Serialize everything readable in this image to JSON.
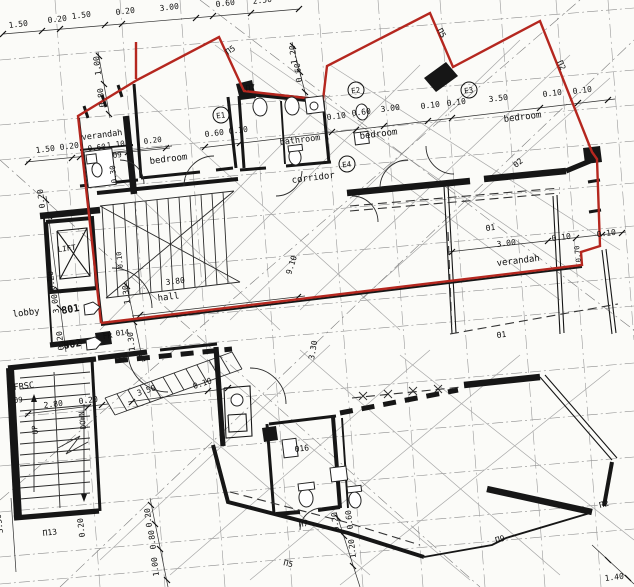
{
  "colors": {
    "paper": "#fbfbf8",
    "ink": "#161616",
    "red_outline": "#b5271f"
  },
  "plan": {
    "rooms": [
      "verandah",
      "bedroom",
      "bathroom",
      "bedroom",
      "bedroom",
      "corridor",
      "hall",
      "lobby",
      "LIFT",
      "verandah",
      "FRSC"
    ],
    "unit_markers": [
      "801",
      "802"
    ],
    "circled_refs": [
      "E1",
      "E2",
      "E3",
      "E4"
    ]
  },
  "labels": [
    {
      "t": "1.50",
      "x": 9,
      "y": 28,
      "n": "dim"
    },
    {
      "t": "0.20",
      "x": 48,
      "y": 23,
      "n": "dim"
    },
    {
      "t": "1.50",
      "x": 72,
      "y": 19,
      "n": "dim"
    },
    {
      "t": "0.20",
      "x": 116,
      "y": 15,
      "n": "dim"
    },
    {
      "t": "3.00",
      "x": 160,
      "y": 11,
      "n": "dim"
    },
    {
      "t": "0.60",
      "x": 216,
      "y": 7,
      "n": "dim"
    },
    {
      "t": "2.50",
      "x": 253,
      "y": 4,
      "n": "dim"
    },
    {
      "t": "1.00",
      "x": 101,
      "y": 75,
      "r": -97,
      "n": "dim"
    },
    {
      "t": "0.80",
      "x": 105,
      "y": 107,
      "r": -97,
      "n": "dim"
    },
    {
      "t": "1.20",
      "x": 297,
      "y": 64,
      "r": -97,
      "n": "dim"
    },
    {
      "t": "0.60",
      "x": 302,
      "y": 82,
      "r": -97,
      "n": "dim"
    },
    {
      "t": "1.50",
      "x": 36,
      "y": 153,
      "n": "dim"
    },
    {
      "t": "0.20",
      "x": 60,
      "y": 150,
      "n": "dim"
    },
    {
      "t": "verandah",
      "x": 82,
      "y": 140,
      "s": 8.5,
      "n": "room-verandah-nw"
    },
    {
      "t": "0.60",
      "x": 88,
      "y": 151,
      "s": 7.5,
      "n": "dim"
    },
    {
      "t": "1.10",
      "x": 107,
      "y": 148,
      "s": 7.5,
      "n": "dim"
    },
    {
      "t": "0.20",
      "x": 144,
      "y": 144,
      "s": 7.5,
      "n": "dim"
    },
    {
      "t": "Θ9",
      "x": 113,
      "y": 158,
      "s": 7.5,
      "n": "door-code"
    },
    {
      "t": "0.30",
      "x": 117,
      "y": 183,
      "r": -97,
      "s": 7.5,
      "n": "dim"
    },
    {
      "t": "bedroom",
      "x": 150,
      "y": 164,
      "s": 9,
      "n": "room-bedroom-1"
    },
    {
      "t": "bathroom",
      "x": 280,
      "y": 145,
      "s": 8.5,
      "n": "room-bathroom"
    },
    {
      "t": "bedroom",
      "x": 360,
      "y": 139,
      "s": 9,
      "n": "room-bedroom-2"
    },
    {
      "t": "bedroom",
      "x": 504,
      "y": 122,
      "s": 9,
      "n": "room-bedroom-3"
    },
    {
      "t": "corridor",
      "x": 292,
      "y": 183,
      "s": 9,
      "n": "room-corridor"
    },
    {
      "t": "E1",
      "x": 221,
      "y": 118,
      "c": true,
      "n": "ref-e1"
    },
    {
      "t": "E2",
      "x": 356,
      "y": 93,
      "c": true,
      "n": "ref-e2"
    },
    {
      "t": "E3",
      "x": 469,
      "y": 93,
      "c": true,
      "n": "ref-e3"
    },
    {
      "t": "E4",
      "x": 347,
      "y": 167,
      "c": true,
      "n": "ref-e4"
    },
    {
      "t": "Π5",
      "x": 228,
      "y": 55,
      "r": -35,
      "n": "window-code"
    },
    {
      "t": "Π7",
      "x": 246,
      "y": 91,
      "n": "window-code"
    },
    {
      "t": "Π5",
      "x": 437,
      "y": 30,
      "r": 62,
      "n": "window-code"
    },
    {
      "t": "Π2",
      "x": 557,
      "y": 62,
      "r": 65,
      "n": "window-code"
    },
    {
      "t": "Θ2",
      "x": 516,
      "y": 168,
      "r": -40,
      "n": "door-code"
    },
    {
      "t": "0.60",
      "x": 205,
      "y": 137,
      "n": "dim"
    },
    {
      "t": "0.10",
      "x": 229,
      "y": 134,
      "n": "dim"
    },
    {
      "t": "0.10",
      "x": 327,
      "y": 120,
      "n": "dim"
    },
    {
      "t": "0.60",
      "x": 352,
      "y": 116,
      "n": "dim"
    },
    {
      "t": "3.00",
      "x": 381,
      "y": 112,
      "n": "dim"
    },
    {
      "t": "0.10",
      "x": 421,
      "y": 109,
      "n": "dim"
    },
    {
      "t": "0.10",
      "x": 447,
      "y": 106,
      "n": "dim"
    },
    {
      "t": "3.50",
      "x": 489,
      "y": 102,
      "n": "dim"
    },
    {
      "t": "0.10",
      "x": 543,
      "y": 97,
      "n": "dim"
    },
    {
      "t": "0.10",
      "x": 573,
      "y": 94,
      "n": "dim"
    },
    {
      "t": "Θ1",
      "x": 486,
      "y": 231,
      "n": "door-code"
    },
    {
      "t": "3.00",
      "x": 497,
      "y": 247,
      "n": "dim"
    },
    {
      "t": "0.10",
      "x": 552,
      "y": 241,
      "n": "dim"
    },
    {
      "t": "0.10",
      "x": 597,
      "y": 237,
      "n": "dim"
    },
    {
      "t": "0.70",
      "x": 581,
      "y": 262,
      "r": -97,
      "s": 7,
      "n": "dim"
    },
    {
      "t": "verandah",
      "x": 497,
      "y": 266,
      "s": 9,
      "n": "room-verandah-e"
    },
    {
      "t": "Θ1",
      "x": 497,
      "y": 338,
      "n": "door-code"
    },
    {
      "t": "3.30",
      "x": 314,
      "y": 360,
      "r": -80,
      "n": "dim"
    },
    {
      "t": "9.10",
      "x": 291,
      "y": 275,
      "r": -72,
      "n": "dim"
    },
    {
      "t": "0.20",
      "x": 45,
      "y": 208,
      "r": -97,
      "n": "dim"
    },
    {
      "t": "LIFT",
      "x": 58,
      "y": 252,
      "s": 7.5,
      "n": "room-lift"
    },
    {
      "t": "0.20",
      "x": 55,
      "y": 290,
      "r": -97,
      "n": "dim"
    },
    {
      "t": "3.00",
      "x": 59,
      "y": 313,
      "r": -97,
      "n": "dim"
    },
    {
      "t": "0.20",
      "x": 64,
      "y": 350,
      "r": -97,
      "n": "dim"
    },
    {
      "t": "lobby",
      "x": 13,
      "y": 317,
      "s": 9,
      "n": "room-lobby"
    },
    {
      "t": "801",
      "x": 62,
      "y": 314,
      "r": -10,
      "s": 10,
      "b": true,
      "n": "unit-801"
    },
    {
      "t": "802",
      "x": 64,
      "y": 349,
      "r": -10,
      "s": 10,
      "b": true,
      "n": "unit-802"
    },
    {
      "t": "FR",
      "x": 103,
      "y": 339,
      "s": 8,
      "n": "label-fr"
    },
    {
      "t": "Θ14",
      "x": 116,
      "y": 336,
      "s": 7.5,
      "n": "door-code"
    },
    {
      "t": "1.30",
      "x": 130,
      "y": 304,
      "r": -97,
      "n": "dim"
    },
    {
      "t": "1.30",
      "x": 135,
      "y": 351,
      "r": -97,
      "n": "dim"
    },
    {
      "t": "hall",
      "x": 158,
      "y": 301,
      "s": 9,
      "n": "room-hall"
    },
    {
      "t": "3.80",
      "x": 166,
      "y": 285,
      "n": "dim"
    },
    {
      "t": "0.10",
      "x": 123,
      "y": 268,
      "r": -97,
      "s": 7,
      "n": "dim"
    },
    {
      "t": "FRSC",
      "x": 14,
      "y": 390,
      "s": 8.5,
      "n": "label-frsc"
    },
    {
      "t": "Θ9",
      "x": 14,
      "y": 403,
      "s": 7.5,
      "n": "door-code"
    },
    {
      "t": "2.80",
      "x": 44,
      "y": 408,
      "n": "dim"
    },
    {
      "t": "0.20",
      "x": 79,
      "y": 404,
      "n": "dim"
    },
    {
      "t": "UP",
      "x": 38,
      "y": 434,
      "r": -97,
      "s": 7.5,
      "n": "stair-up"
    },
    {
      "t": "DOWN",
      "x": 86,
      "y": 429,
      "r": -97,
      "s": 7.5,
      "n": "stair-down"
    },
    {
      "t": "3.50",
      "x": 3,
      "y": 533,
      "r": -97,
      "n": "dim"
    },
    {
      "t": "Π13",
      "x": 43,
      "y": 536,
      "n": "window-code"
    },
    {
      "t": "0.20",
      "x": 85,
      "y": 537,
      "r": -97,
      "n": "dim"
    },
    {
      "t": "3.50",
      "x": 138,
      "y": 396,
      "r": -18,
      "n": "dim"
    },
    {
      "t": "0.10",
      "x": 194,
      "y": 389,
      "r": -18,
      "n": "dim"
    },
    {
      "t": "Θ16",
      "x": 295,
      "y": 452,
      "n": "door-code"
    },
    {
      "t": "Π7",
      "x": 299,
      "y": 527,
      "n": "window-code"
    },
    {
      "t": "Π5",
      "x": 283,
      "y": 565,
      "r": 14,
      "n": "window-code"
    },
    {
      "t": "0.20",
      "x": 152,
      "y": 527,
      "r": -97,
      "n": "dim"
    },
    {
      "t": "0.80",
      "x": 156,
      "y": 549,
      "r": -97,
      "n": "dim"
    },
    {
      "t": "1.00",
      "x": 159,
      "y": 576,
      "r": -97,
      "n": "dim"
    },
    {
      "t": "0.20",
      "x": 339,
      "y": 531,
      "r": -97,
      "n": "dim"
    },
    {
      "t": "0.60",
      "x": 353,
      "y": 529,
      "r": -97,
      "n": "dim"
    },
    {
      "t": "1.20",
      "x": 356,
      "y": 558,
      "r": -97,
      "n": "dim"
    },
    {
      "t": "Π9",
      "x": 496,
      "y": 543,
      "r": -15,
      "n": "window-code"
    },
    {
      "t": "Π2",
      "x": 600,
      "y": 508,
      "r": -15,
      "n": "window-code"
    },
    {
      "t": "1.40",
      "x": 605,
      "y": 581,
      "n": "dim"
    }
  ]
}
